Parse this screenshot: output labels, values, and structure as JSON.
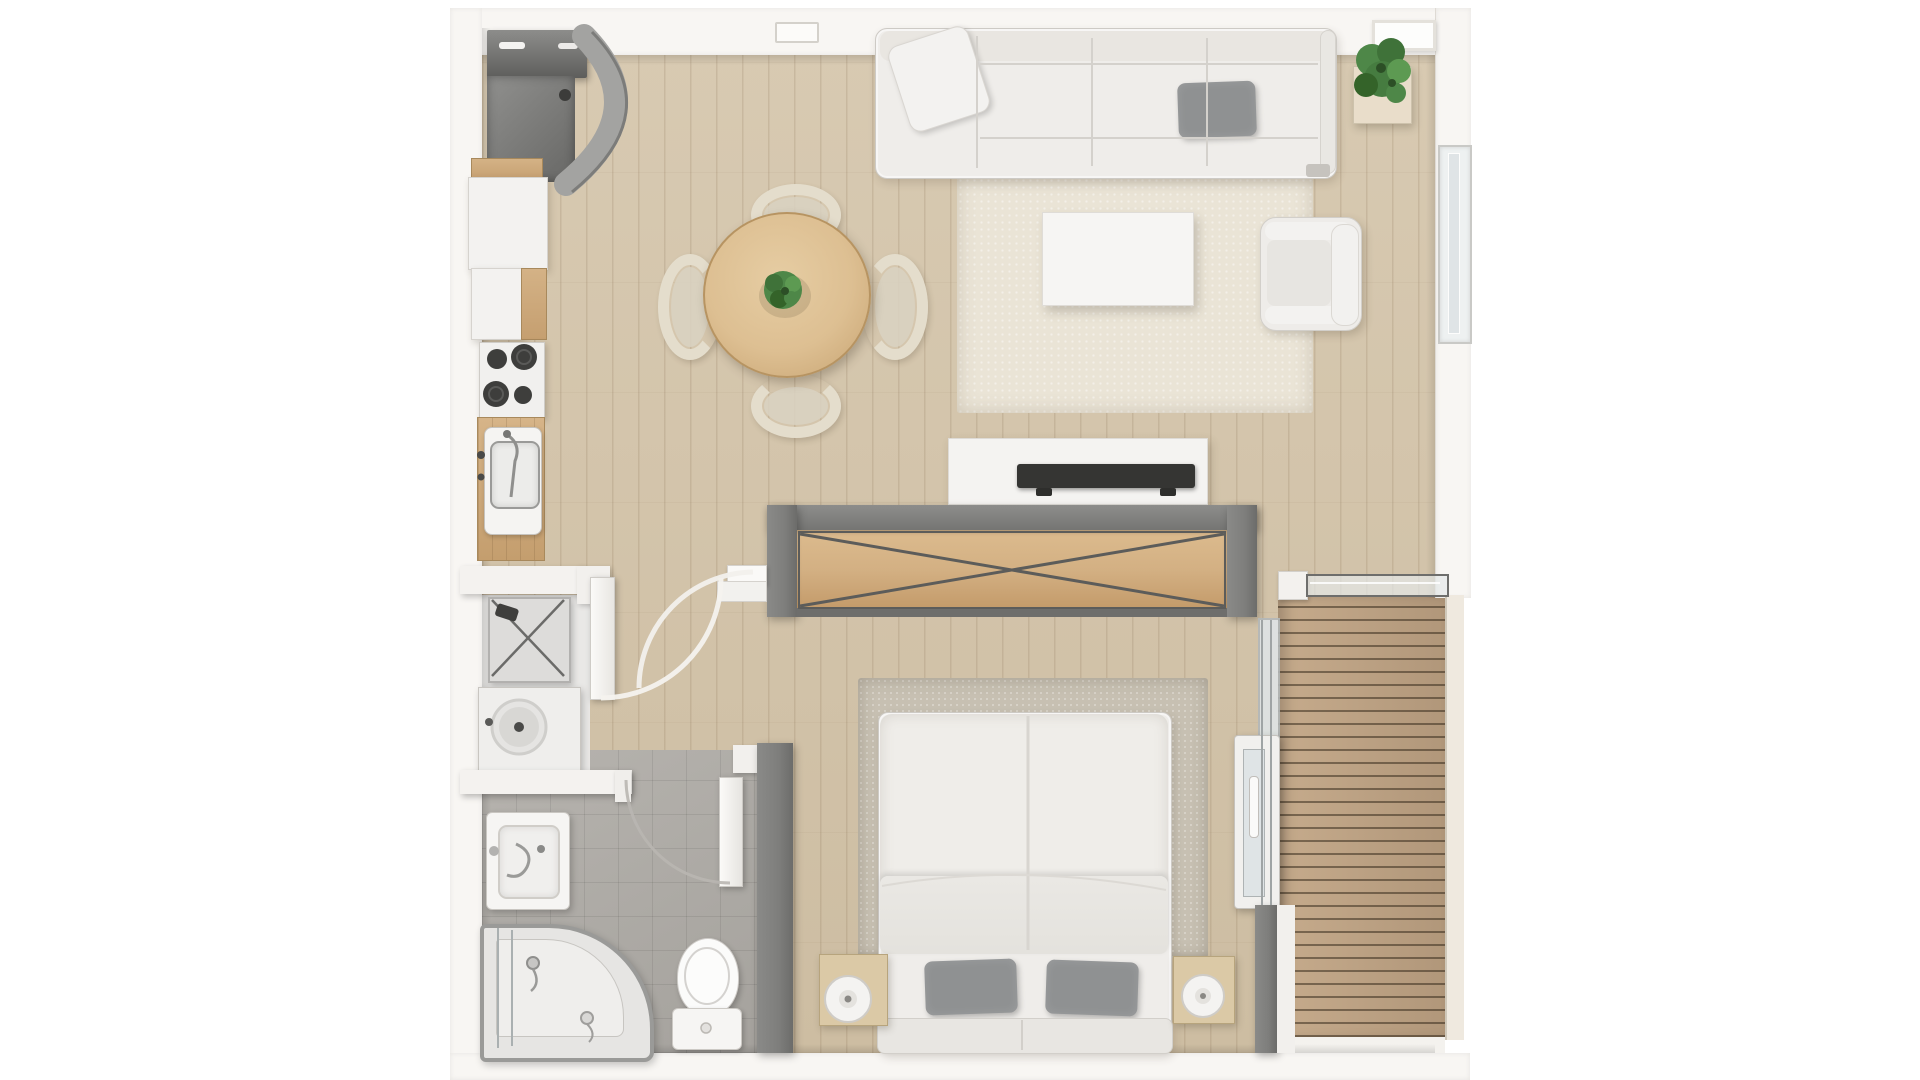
{
  "scene": {
    "kind": "apartment-floor-plan-top-view",
    "rooms": [
      {
        "name": "kitchen",
        "items": [
          "entrance-door",
          "tall-cabinet",
          "base-cabinet",
          "cooktop",
          "kitchen-sink",
          "wood-counter"
        ]
      },
      {
        "name": "dining",
        "items": [
          "round-table",
          "table-plant",
          "chair-top",
          "chair-bottom",
          "chair-left",
          "chair-right"
        ]
      },
      {
        "name": "living",
        "items": [
          "sofa",
          "white-pillow",
          "gray-pillow",
          "area-rug",
          "coffee-table",
          "armchair",
          "corner-plant",
          "tv-console",
          "tv"
        ]
      },
      {
        "name": "laundry-closet",
        "items": [
          "closet-door",
          "storage-box",
          "washing-machine"
        ]
      },
      {
        "name": "bathroom",
        "items": [
          "bathroom-door",
          "washbasin",
          "corner-shower",
          "toilet"
        ]
      },
      {
        "name": "bedroom",
        "items": [
          "double-bed",
          "duvet",
          "bed-pillows",
          "headboard",
          "nightstand-left",
          "nightstand-right",
          "table-lamps",
          "bedroom-rug",
          "sliding-glass-door"
        ]
      },
      {
        "name": "balcony",
        "items": [
          "wood-deck",
          "glass-railing",
          "railing-post"
        ]
      },
      {
        "name": "divider",
        "items": [
          "wardrobe-unit",
          "cross-braced-doors"
        ]
      }
    ]
  },
  "labels": {
    "floor_plan": "apartment floor plan, top view",
    "top_wall": "top exterior wall",
    "left_wall": "left exterior wall",
    "bottom_wall": "bottom exterior wall",
    "right_wall": "right exterior wall",
    "window": "window in right wall",
    "ceiling_light": "ceiling light fixture",
    "entry_door": "entrance door (open, dark gray)",
    "entry_swing": "entrance door swing",
    "fridge": "tall kitchen cabinet / fridge",
    "cabinet": "kitchen base cabinet",
    "counter": "wooden countertop",
    "cooktop": "cooktop with four burners",
    "sink": "kitchen sink",
    "dining_table": "round wooden dining table",
    "table_plant": "green plant centerpiece",
    "chair": "dining chair",
    "sofa": "white three-seat sofa with chaise",
    "white_pillow": "white throw pillow",
    "gray_pillow": "gray throw pillow",
    "living_rug": "living room rug",
    "coffee_table": "white coffee table",
    "armchair": "white armchair",
    "corner_plant": "potted plant",
    "planter": "square planter",
    "tv_console": "white media console",
    "tv": "flat screen TV",
    "wardrobe": "wardrobe room divider with crossed wood doors",
    "inner_door": "interior door",
    "door_swing": "door swing arc",
    "closet_box": "storage box with cross straps",
    "washer": "washing machine",
    "shelf": "wall shelf / partition ledge",
    "washbasin": "bathroom washbasin",
    "shower": "corner shower with glass panel",
    "toilet": "toilet",
    "partition": "partition wall",
    "bed": "double bed",
    "duvet": "white duvet",
    "blanket": "folded blanket",
    "bed_pillow": "gray bed pillow",
    "headboard": "bed headboard",
    "nightstand": "wooden nightstand",
    "lamp": "round table lamp",
    "bedroom_rug": "bedroom rug",
    "glass_door": "sliding glass balcony door",
    "glass_pane": "glass side panel",
    "deck": "balcony wood deck",
    "railing": "glass balcony railing",
    "post": "railing post"
  },
  "palette": {
    "page_bg": "#ffffff",
    "wall": "#f8f6f3",
    "wood_floor": "#d8cab2",
    "deck": "#c6ab8c",
    "tile": "#b6b3ae",
    "rug_living": "#eae4d6",
    "rug_bedroom": "#c7c0b2",
    "upholstery": "#efedea",
    "upholstery_line": "#cdcac5",
    "pillow_gray": "#8f9192",
    "chair": "#e4ddcc",
    "table_wood": "#ddbf92",
    "wardrobe_wood": "#d3b083",
    "partition_gray": "#7e7e7c",
    "door_dark": "#6f6f6d",
    "plant_green": "#4e8748",
    "tv_black": "#353533",
    "glass": "#dfe4e6",
    "nightstand_wood": "#dbc9a6"
  }
}
